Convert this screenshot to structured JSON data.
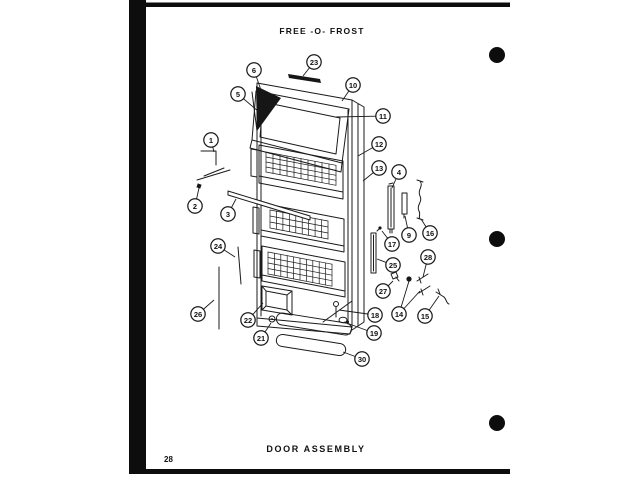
{
  "page": {
    "title": "FREE -O- FROST",
    "caption": "DOOR ASSEMBLY",
    "page_number": "28"
  },
  "colors": {
    "ink": "#1b1b1b",
    "paper": "#ffffff"
  },
  "diagram": {
    "subject": "Exploded parts view of freezer door assembly with numbered callouts",
    "callouts": [
      {
        "n": "23",
        "cx": 314,
        "cy": 62,
        "targets": [
          [
            303,
            76
          ]
        ]
      },
      {
        "n": "6",
        "cx": 254,
        "cy": 70,
        "targets": [
          [
            262,
            93
          ]
        ]
      },
      {
        "n": "5",
        "cx": 238,
        "cy": 94,
        "targets": [
          [
            259,
            112
          ]
        ]
      },
      {
        "n": "10",
        "cx": 353,
        "cy": 85,
        "targets": [
          [
            342,
            101
          ]
        ]
      },
      {
        "n": "11",
        "cx": 383,
        "cy": 116,
        "targets": [
          [
            336,
            117
          ]
        ]
      },
      {
        "n": "12",
        "cx": 379,
        "cy": 144,
        "targets": [
          [
            358,
            156
          ]
        ]
      },
      {
        "n": "13",
        "cx": 379,
        "cy": 168,
        "targets": [
          [
            363,
            181
          ]
        ]
      },
      {
        "n": "1",
        "cx": 211,
        "cy": 140,
        "targets": [
          [
            214,
            152
          ]
        ]
      },
      {
        "n": "2",
        "cx": 195,
        "cy": 206,
        "targets": [
          [
            199,
            188
          ]
        ]
      },
      {
        "n": "3",
        "cx": 228,
        "cy": 214,
        "targets": [
          [
            236,
            199
          ]
        ]
      },
      {
        "n": "4",
        "cx": 399,
        "cy": 172,
        "targets": [
          [
            392,
            188
          ]
        ]
      },
      {
        "n": "9",
        "cx": 409,
        "cy": 235,
        "targets": [
          [
            405,
            216
          ]
        ]
      },
      {
        "n": "16",
        "cx": 430,
        "cy": 233,
        "targets": [
          [
            421,
            219
          ]
        ]
      },
      {
        "n": "17",
        "cx": 392,
        "cy": 244,
        "targets": [
          [
            382,
            231
          ]
        ]
      },
      {
        "n": "25",
        "cx": 393,
        "cy": 265,
        "targets": [
          [
            377,
            259
          ]
        ]
      },
      {
        "n": "28",
        "cx": 428,
        "cy": 257,
        "targets": [
          [
            423,
            277
          ]
        ]
      },
      {
        "n": "27",
        "cx": 383,
        "cy": 291,
        "targets": [
          [
            393,
            281
          ]
        ]
      },
      {
        "n": "14",
        "cx": 399,
        "cy": 314,
        "targets": [
          [
            409,
            281
          ],
          [
            420,
            291
          ]
        ]
      },
      {
        "n": "15",
        "cx": 425,
        "cy": 316,
        "targets": [
          [
            439,
            296
          ]
        ]
      },
      {
        "n": "18",
        "cx": 375,
        "cy": 315,
        "targets": [
          [
            339,
            310
          ]
        ]
      },
      {
        "n": "19",
        "cx": 374,
        "cy": 333,
        "targets": [
          [
            344,
            322
          ]
        ]
      },
      {
        "n": "24",
        "cx": 218,
        "cy": 246,
        "targets": [
          [
            235,
            257
          ]
        ]
      },
      {
        "n": "26",
        "cx": 198,
        "cy": 314,
        "targets": [
          [
            214,
            300
          ]
        ]
      },
      {
        "n": "22",
        "cx": 248,
        "cy": 320,
        "targets": [
          [
            263,
            303
          ]
        ]
      },
      {
        "n": "21",
        "cx": 261,
        "cy": 338,
        "targets": [
          [
            271,
            323
          ]
        ]
      },
      {
        "n": "30",
        "cx": 362,
        "cy": 359,
        "targets": [
          [
            343,
            352
          ]
        ]
      }
    ]
  }
}
